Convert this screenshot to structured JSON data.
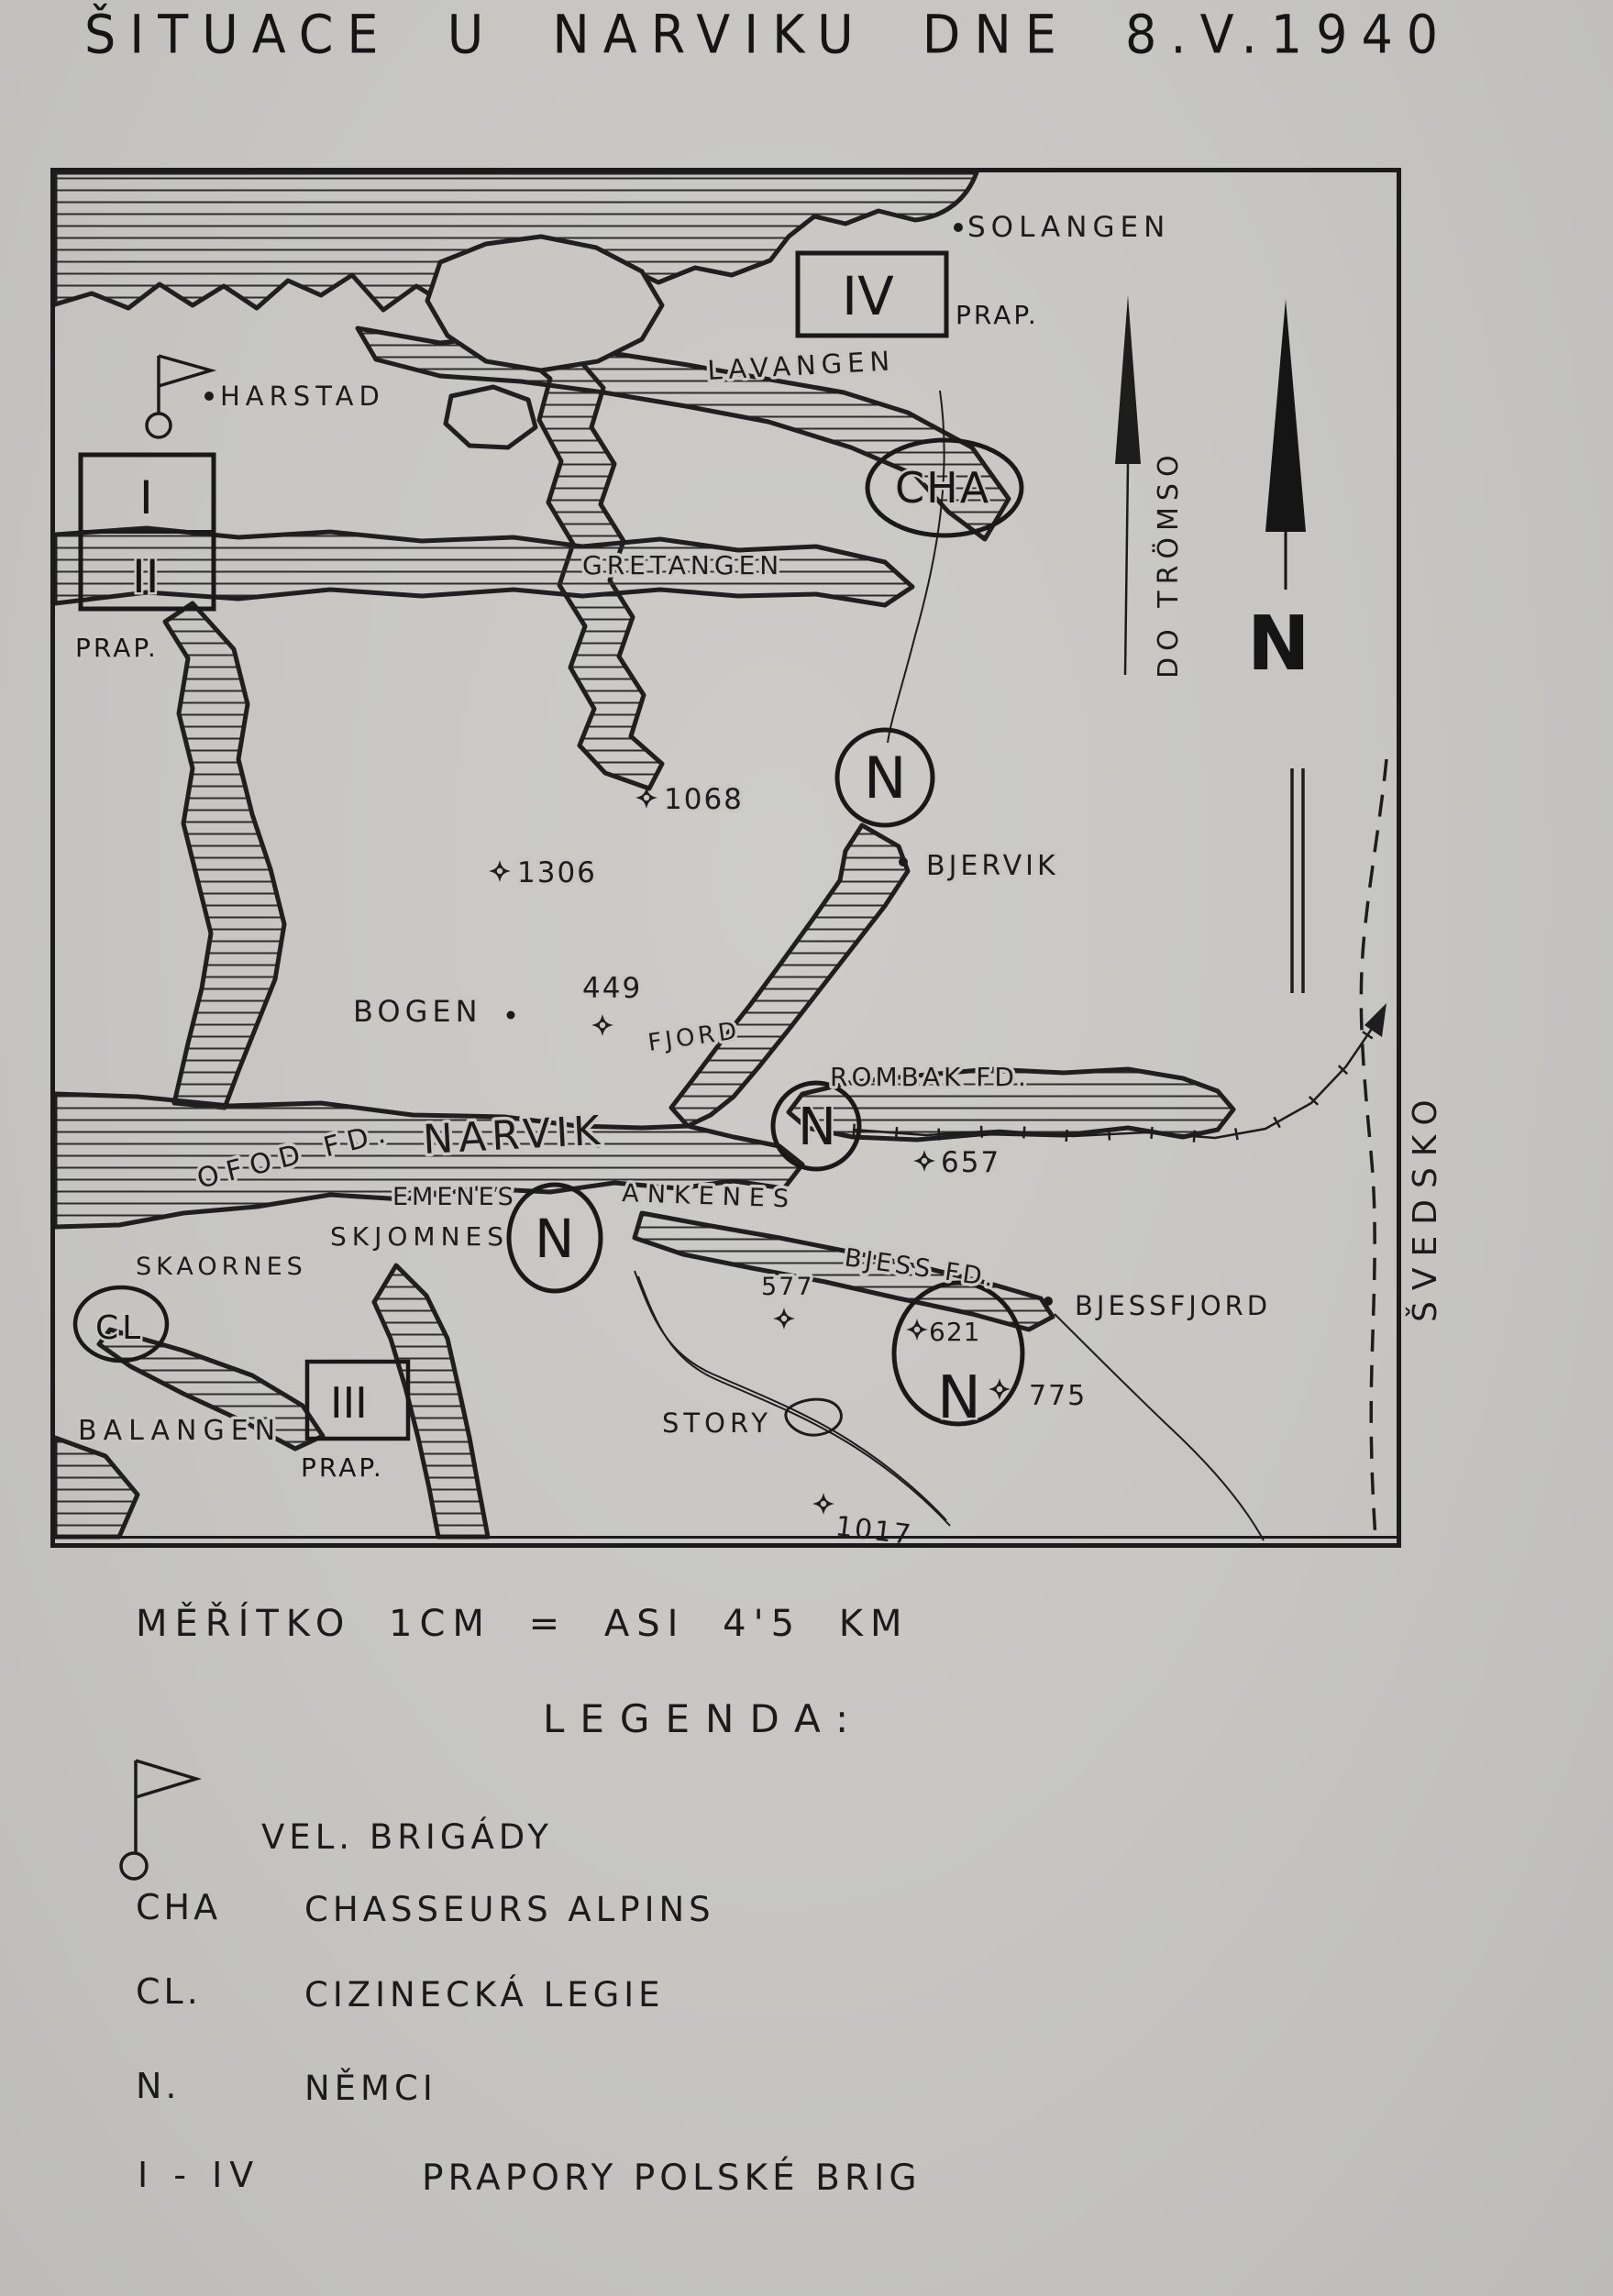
{
  "title": "ŠITUACE U NARVIKU DNE 8.V.1940",
  "map": {
    "labels": {
      "solangen": "SOLANGEN",
      "lavangen": "LAVANGEN",
      "harstad": "HARSTAD",
      "gretangen": "GRETANGEN",
      "bjervik": "BJERVIK",
      "bogen": "BOGEN",
      "fjord": "FJORD",
      "rombak": "ROMBAK FD.",
      "narvik": "NARVIK",
      "ofod": "OFOD FD.",
      "emenes": "EMENES",
      "ankenes": "ANKENES",
      "skjomnes": "SKJOMNES",
      "skaornes": "SKAORNES",
      "bjess_fd": "BJESS FD.",
      "bjessfjord": "BJESSFJORD",
      "balangen": "BALANGEN",
      "story": "STORY"
    },
    "annotations": {
      "svedsko": "ŠVEDSKO",
      "do_tromso": "DO TRÖMSO",
      "north": "N"
    },
    "units": {
      "iv": "IV",
      "i": "I",
      "ii": "II",
      "iii": "III",
      "prap": "PRAP.",
      "cha": "CHA",
      "cl": "CL",
      "n": "N"
    },
    "summits": {
      "e1068": "1068",
      "e1306": "1306",
      "e449": "449",
      "e657": "657",
      "e577": "577",
      "e621": "621",
      "e775": "775",
      "e1017": "1017"
    }
  },
  "scale_note": "MĚŘÍTKO 1CM = ASI 4'5 KM",
  "legend": {
    "heading": "LEGENDA:",
    "items": [
      {
        "key": "",
        "label": "VEL. BRIGÁDY"
      },
      {
        "key": "CHA",
        "label": "CHASSEURS ALPINS"
      },
      {
        "key": "CL.",
        "label": "CIZINECKÁ LEGIE"
      },
      {
        "key": "N.",
        "label": "NĚMCI"
      },
      {
        "key": "I - IV",
        "label": "PRAPORY POLSKÉ BRIG"
      }
    ]
  }
}
